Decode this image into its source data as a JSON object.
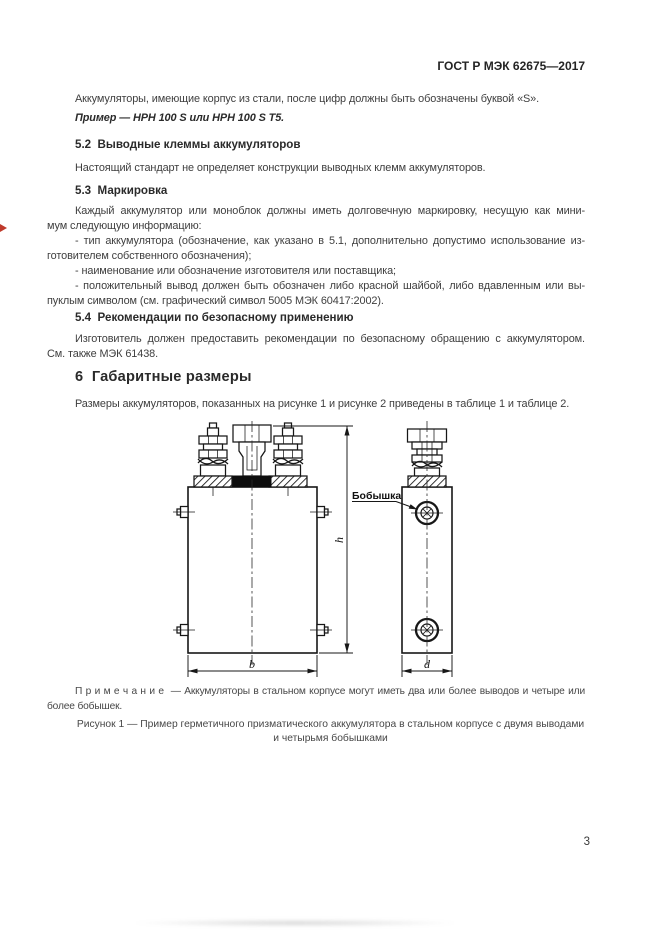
{
  "header": {
    "doc_code": "ГОСТ Р МЭК 62675—2017"
  },
  "content": {
    "intro": "Аккумуляторы, имеющие корпус из стали, после цифр должны быть обозначены буквой «S».",
    "example": "Пример — НРН 100 S или НРН 100 S Т5.",
    "s52": {
      "heading": "5.2  Выводные клеммы аккумуляторов",
      "text": "Настоящий стандарт не определяет конструкции выводных клемм аккумуляторов."
    },
    "s53": {
      "heading": "5.3  Маркировка",
      "lines": [
        "Каждый аккумулятор или моноблок должны иметь долговечную маркировку, несущую как мини-",
        "мум следующую информацию:",
        "- тип аккумулятора (обозначение, как указано в 5.1, дополнительно допустимо использование из-",
        "готовителем собственного обозначения);",
        "- наименование или обозначение изготовителя или поставщика;",
        "- положительный вывод должен быть обозначен либо красной шайбой, либо вдавленным или вы-",
        "пуклым символом (см. графический символ 5005 МЭК 60417:2002)."
      ]
    },
    "s54": {
      "heading": "5.4  Рекомендации по безопасному применению",
      "lines": [
        "Изготовитель должен предоставить рекомендации по безопасному обращению с аккумулятором.",
        "См. также МЭК 61438."
      ]
    },
    "s6": {
      "heading": "6  Габаритные размеры",
      "text": "Размеры аккумуляторов, показанных на рисунке 1 и рисунке 2 приведены в таблице 1 и таблице 2."
    }
  },
  "figure": {
    "boss_label": "Бобышка",
    "dim_h": "h",
    "dim_b": "b",
    "dim_d": "d",
    "note_lines": [
      "П р и м е ч а н и е  — Аккумуляторы в стальном корпусе могут иметь два или более выводов и четыре или",
      "более бобышек."
    ],
    "caption_lines": [
      "Рисунок 1 — Пример герметичного призматического аккумулятора в стальном корпусе с двумя выводами",
      "и четырьмя бобышками"
    ]
  },
  "footer": {
    "page_number": "3"
  }
}
